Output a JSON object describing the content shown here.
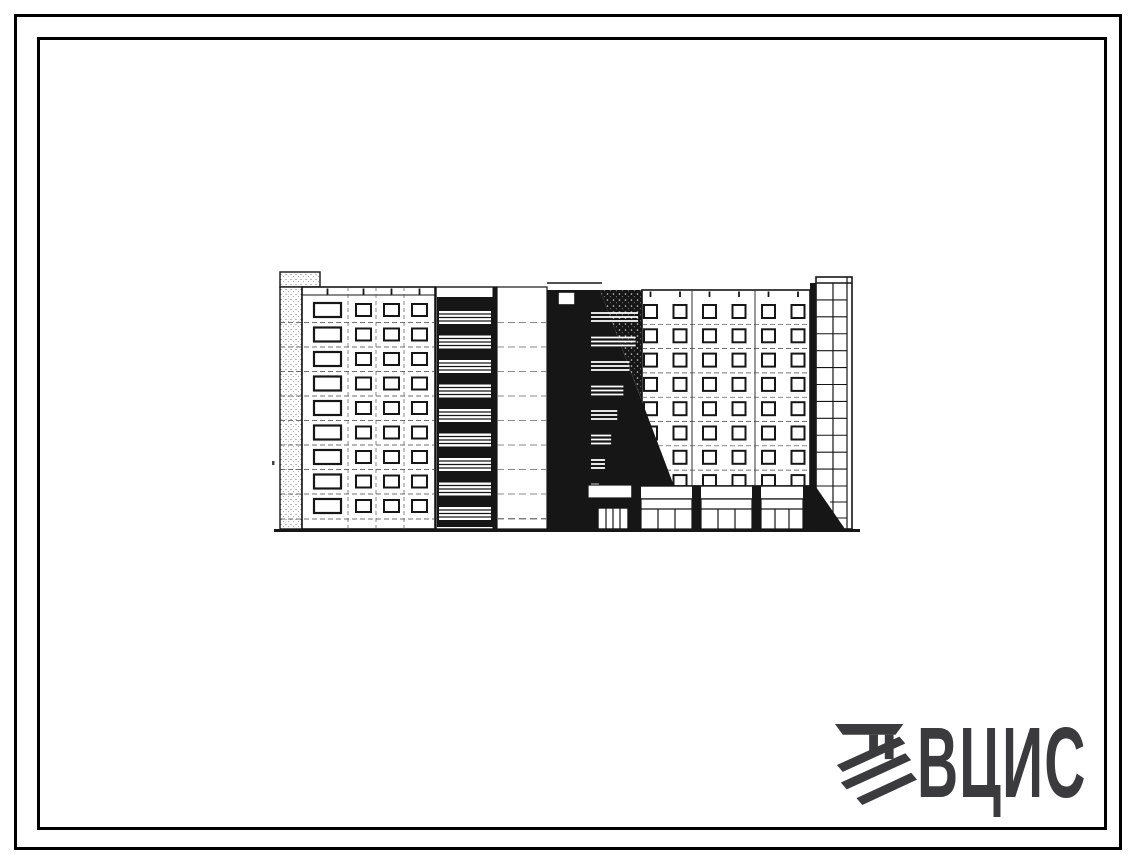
{
  "page": {
    "background_color": "#ffffff",
    "description": "Scanned catalogue sheet of a standard-series residential building, street facade elevation, with double black page border and publisher watermark at bottom right"
  },
  "frame": {
    "border_color": "#000000",
    "style": "double rectangular border"
  },
  "drawing": {
    "title": "Nine-storey panel apartment building - facade elevation",
    "kind": "architectural-elevation",
    "ink_color": "#161616",
    "floors_left_block": 9,
    "left_block_wide_window_column": 1,
    "left_block_small_window_columns": 3,
    "balcony_tiers": 9,
    "window_rows_right_block": 8,
    "window_columns_right_block": 6,
    "storefront_bays": 3,
    "stair_tower_glazing_rows": 13
  },
  "logo": {
    "text": "ВЦИС",
    "color": "#3b3b3d"
  }
}
